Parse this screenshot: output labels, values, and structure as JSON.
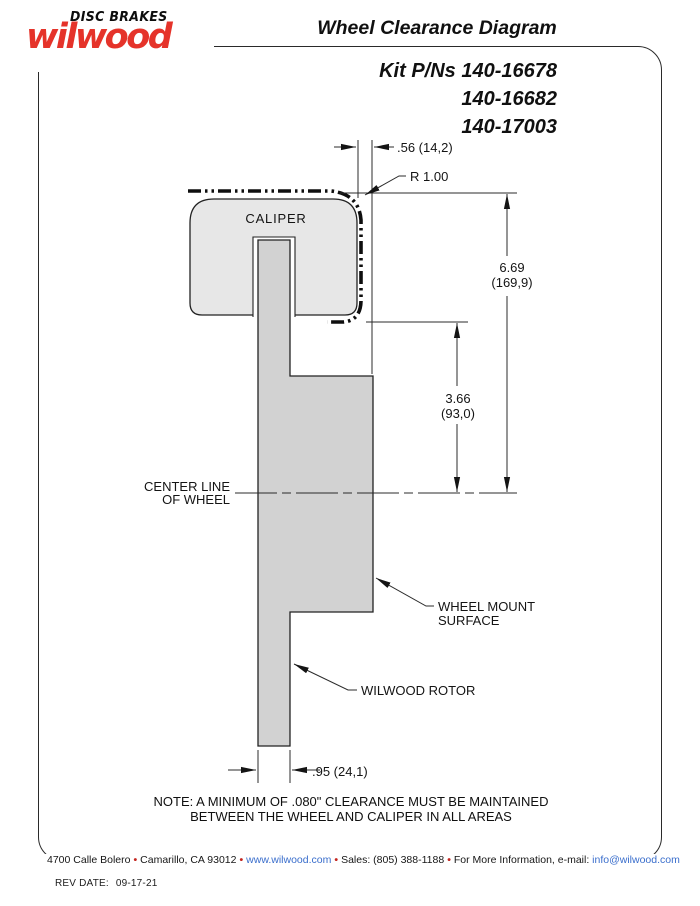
{
  "logo": {
    "tagline": "DISC BRAKES",
    "brand": "wilwood"
  },
  "header": {
    "title": "Wheel Clearance Diagram"
  },
  "kit": {
    "line1": "Kit P/Ns 140-16678",
    "line2": "140-16682",
    "line3": "140-17003"
  },
  "diagram": {
    "caliper_label": "CALIPER",
    "dim_caliper_overhang": ".56 (14,2)",
    "radius_label": "R 1.00",
    "dim_wheel_height_in": "6.69",
    "dim_wheel_height_mm": "(169,9)",
    "dim_mount_height_in": "3.66",
    "dim_mount_height_mm": "(93,0)",
    "centerline_label_line1": "CENTER LINE",
    "centerline_label_line2": "OF WHEEL",
    "wheel_mount_label_line1": "WHEEL MOUNT",
    "wheel_mount_label_line2": "SURFACE",
    "rotor_label": "WILWOOD ROTOR",
    "dim_rotor_width": ".95 (24,1)"
  },
  "note": {
    "line1": "NOTE: A MINIMUM OF .080\" CLEARANCE MUST BE MAINTAINED",
    "line2": "BETWEEN THE WHEEL AND CALIPER IN ALL AREAS"
  },
  "footer": {
    "sep": "•",
    "address": "4700 Calle Bolero",
    "city": "Camarillo, CA 93012",
    "website": "www.wilwood.com",
    "sales": "Sales: (805) 388-1188",
    "more_info": "For More Information, e-mail:",
    "email": "info@wilwood.com"
  },
  "revision": {
    "label": "REV DATE:",
    "date": "09-17-21"
  },
  "colors": {
    "brand_red": "#e5332a",
    "link_blue": "#3a6ecc",
    "bullet_red": "#c42620",
    "caliper_gray": "#e7e7e7",
    "rotor_gray": "#d2d2d2"
  }
}
